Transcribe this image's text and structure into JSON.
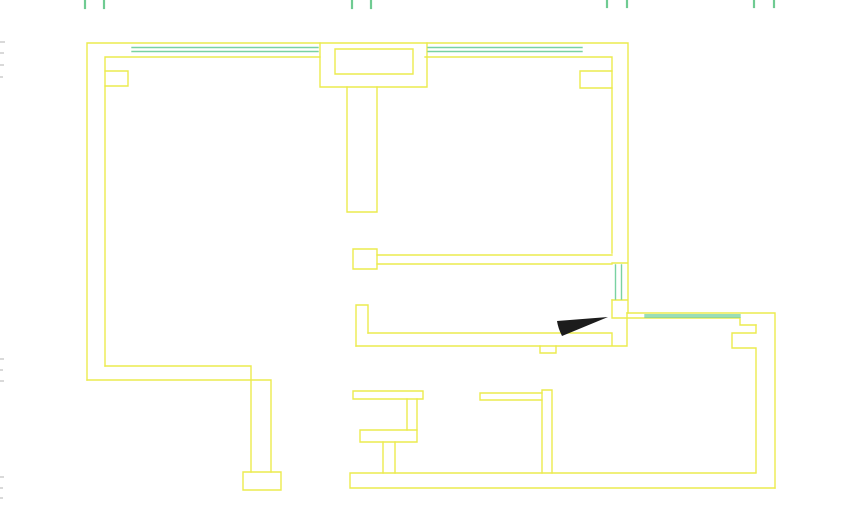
{
  "canvas": {
    "width": 860,
    "height": 525,
    "background": "#ffffff"
  },
  "colors": {
    "wall": "#eceb4e",
    "window": "#79d2a2",
    "tick": "#6fcb92",
    "door_fill": "#1c1c1c",
    "edge_mark": "#d9d9d9"
  },
  "stroke_widths": {
    "wall": 1.4,
    "window": 1.4,
    "tick": 2.2
  },
  "floor_plan": {
    "walls": [
      {
        "name": "outer-shell-left-top-right",
        "d": "M 87 380 L 87 43 L 628 43 L 628 313"
      },
      {
        "name": "inner-left-and-top-left",
        "d": "M 105 366 L 105 57 L 320 57"
      },
      {
        "name": "inner-top-right-segment",
        "d": "M 425 57 L 612 57 L 612 253"
      },
      {
        "name": "pilaster-top-left",
        "d": "M 105 71 L 128 71 L 128 86 L 105 86"
      },
      {
        "name": "pilaster-top-right",
        "d": "M 612 71 L 580 71 L 580 88 L 612 88"
      },
      {
        "name": "bay-outer-rect",
        "d": "M 320 43 L 320 87 L 427 87 L 427 43"
      },
      {
        "name": "bay-inner-rect",
        "d": "M 335 49 L 335 74 L 413 74 L 413 49 Z"
      },
      {
        "name": "center-stem-wall",
        "d": "M 347 87 L 347 212 L 377 212 L 377 87"
      },
      {
        "name": "left-room-bottom-outer",
        "d": "M 87 380 L 271 380 L 271 472"
      },
      {
        "name": "left-room-bottom-inner",
        "d": "M 105 366 L 251 366 L 251 472"
      },
      {
        "name": "wall-end-cap",
        "d": "M 243 472 L 281 472 L 281 490 L 243 490 Z"
      },
      {
        "name": "mid-band-square-post",
        "d": "M 353 249 L 377 249 L 377 269 L 353 269 Z"
      },
      {
        "name": "mid-band-top-wall",
        "d": "M 377 255 H 612 M 377 264 H 612"
      },
      {
        "name": "vertical-window-caps",
        "d": "M 612 263 H 627 M 612 300 H 627"
      },
      {
        "name": "right-room-top-inner",
        "d": "M 612 300 L 612 318 L 740 318 L 740 325 L 756 325"
      },
      {
        "name": "right-room-top-and-right-outer",
        "d": "M 627 313 L 775 313 L 775 488"
      },
      {
        "name": "right-room-inner-wall-with-pilaster",
        "d": "M 756 325 V 333 H 732 V 348 H 756 V 472"
      },
      {
        "name": "mid-bottom-wall",
        "d": "M 368 333 H 612 M 356 346 H 627 M 627 313 V 346 M 612 333 V 346"
      },
      {
        "name": "mid-bottom-left-ell",
        "d": "M 356 305 H 368 M 356 305 V 346 M 368 305 V 333"
      },
      {
        "name": "door-threshold-step",
        "d": "M 540 346 V 353 H 556 V 346"
      },
      {
        "name": "bottom-wall",
        "d": "M 350 473 H 756 M 350 488 H 775 M 350 473 V 488"
      },
      {
        "name": "lower-stub-top-bar",
        "d": "M 353 391 H 423 V 399 H 353 Z"
      },
      {
        "name": "lower-stub-vertical",
        "d": "M 407 399 V 430 M 417 399 V 430"
      },
      {
        "name": "lower-stub-mid-bar",
        "d": "M 360 430 H 417 V 442 H 360 Z"
      },
      {
        "name": "lower-stub-stem",
        "d": "M 383 442 V 473 M 395 442 V 473"
      },
      {
        "name": "lower-right-stub-bar",
        "d": "M 480 393 H 542 M 480 400 H 542 M 480 393 V 400"
      },
      {
        "name": "lower-right-partition",
        "d": "M 542 390 H 552 V 473 M 542 390 V 473"
      }
    ],
    "windows": [
      {
        "name": "window-top-left",
        "d": "M 132 47.5 H 318 M 132 51.5 H 318"
      },
      {
        "name": "window-top-right",
        "d": "M 428 47.5 H 582 M 428 51.5 H 582"
      },
      {
        "name": "window-mid-vertical",
        "d": "M 615.5 265 V 299 M 621.5 265 V 299"
      },
      {
        "name": "window-right-room",
        "d": "M 645 315 H 740 M 645 317 H 740"
      }
    ],
    "dimension_ticks": [
      {
        "name": "tick-1a",
        "d": "M 85 0 V 8"
      },
      {
        "name": "tick-1b",
        "d": "M 104 0 V 8"
      },
      {
        "name": "tick-2a",
        "d": "M 352 0 V 8"
      },
      {
        "name": "tick-2b",
        "d": "M 371 0 V 8"
      },
      {
        "name": "tick-3a",
        "d": "M 607 0 V 7"
      },
      {
        "name": "tick-3b",
        "d": "M 627 0 V 7"
      },
      {
        "name": "tick-4a",
        "d": "M 754 0 V 7"
      },
      {
        "name": "tick-4b",
        "d": "M 774 0 V 7"
      }
    ],
    "door_leaf": {
      "name": "door-leaf-filled",
      "d": "M 557 321 L 608 317 L 562 336 Q 558 328 557 321 Z"
    },
    "edge_marks": [
      {
        "x": 0,
        "y": 41,
        "w": 5,
        "h": 2
      },
      {
        "x": 0,
        "y": 52,
        "w": 4,
        "h": 2
      },
      {
        "x": 0,
        "y": 64,
        "w": 4,
        "h": 2
      },
      {
        "x": 0,
        "y": 76,
        "w": 3,
        "h": 2
      },
      {
        "x": 0,
        "y": 358,
        "w": 4,
        "h": 2
      },
      {
        "x": 0,
        "y": 369,
        "w": 3,
        "h": 2
      },
      {
        "x": 0,
        "y": 380,
        "w": 4,
        "h": 2
      },
      {
        "x": 0,
        "y": 476,
        "w": 4,
        "h": 2
      },
      {
        "x": 0,
        "y": 487,
        "w": 3,
        "h": 2
      },
      {
        "x": 0,
        "y": 497,
        "w": 3,
        "h": 2
      }
    ]
  }
}
